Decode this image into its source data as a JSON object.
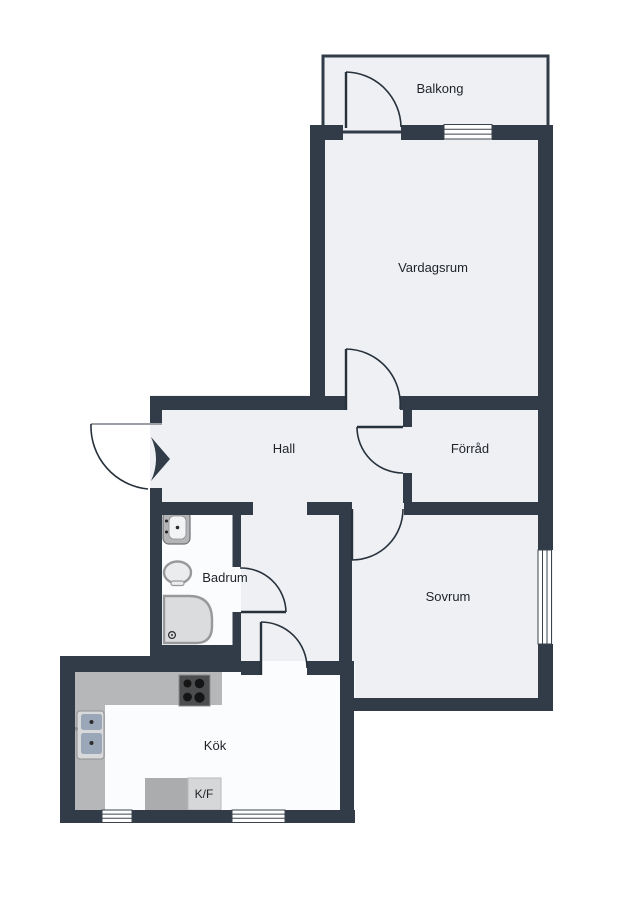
{
  "floorplan": {
    "title": "Apartment floor plan",
    "rooms": [
      {
        "id": "balkong",
        "label": "Balkong"
      },
      {
        "id": "vardagsrum",
        "label": "Vardagsrum"
      },
      {
        "id": "hall",
        "label": "Hall"
      },
      {
        "id": "forrad",
        "label": "Förråd"
      },
      {
        "id": "badrum",
        "label": "Badrum"
      },
      {
        "id": "sovrum",
        "label": "Sovrum"
      },
      {
        "id": "kok",
        "label": "Kök"
      }
    ],
    "appliances": {
      "fridge_freezer_label": "K/F"
    },
    "colors": {
      "background": "#ffffff",
      "wall": "#313c48",
      "floor": "#eef0f3",
      "wet_floor": "#fbfcfd",
      "counter": "#b5b7b9",
      "counter_dark": "#aaacae",
      "appliance_light": "#d6d7d8",
      "stove": "#4b4d4f",
      "burner": "#151515",
      "door_line": "#27313c",
      "entry_leaf": "#9aa0a6",
      "fixture_fill": "#dadcde",
      "fixture_stroke": "#97999c",
      "sink_basin": "#9aa7b8",
      "label_text": "#1f2328"
    }
  }
}
